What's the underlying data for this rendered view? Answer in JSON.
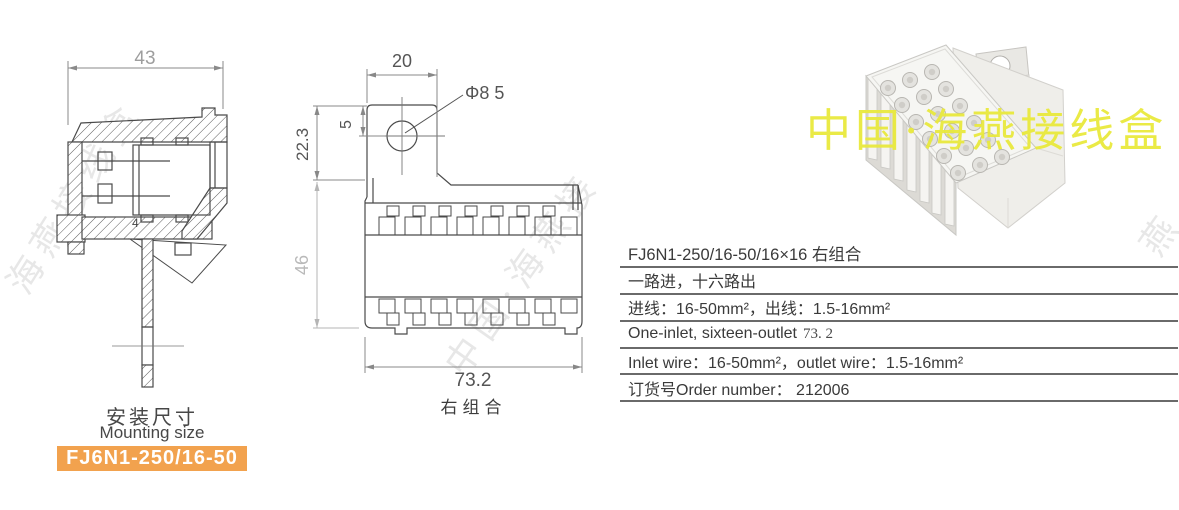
{
  "left_drawing": {
    "dim_width": "43",
    "inner_label": "4",
    "caption_cn": "安装尺寸",
    "caption_en": "Mounting size",
    "badge": {
      "text": "FJ6N1-250/16-50",
      "bg": "#f2a24e",
      "fg": "#ffffff"
    }
  },
  "middle_drawing": {
    "dim_tab_width": "20",
    "dim_hole": "Φ8 5",
    "dim_hole_offset": "5",
    "dim_tab_height": "22.3",
    "dim_body_height": "46",
    "dim_body_width": "73.2",
    "caption": "右组合"
  },
  "photo": {
    "watermark": "中国·海燕接线盒"
  },
  "background_watermark": {
    "text_left": "海燕接线盒",
    "text_mid": "中国·海燕接",
    "text_right": "燕"
  },
  "spec_table": {
    "rows": [
      {
        "text": "FJ6N1-250/16-50/16×16 右组合"
      },
      {
        "text": "一路进，十六路出"
      },
      {
        "text": "进线：16-50mm²，出线：1.5-16mm²"
      },
      {
        "text": "One-inlet, sixteen-outlet",
        "extra": "73. 2"
      },
      {
        "text": "Inlet wire：16-50mm²，outlet wire：1.5-16mm²"
      },
      {
        "text": "订货号Order number： 212006"
      }
    ]
  },
  "colors": {
    "line": "#4a4a4a",
    "dim_dark": "#555555",
    "dim_light": "#9e9e9e",
    "table_rule": "#6a6a6a",
    "badge_orange": "#f2a24e",
    "watermark_yellow": "#e9e93d"
  }
}
